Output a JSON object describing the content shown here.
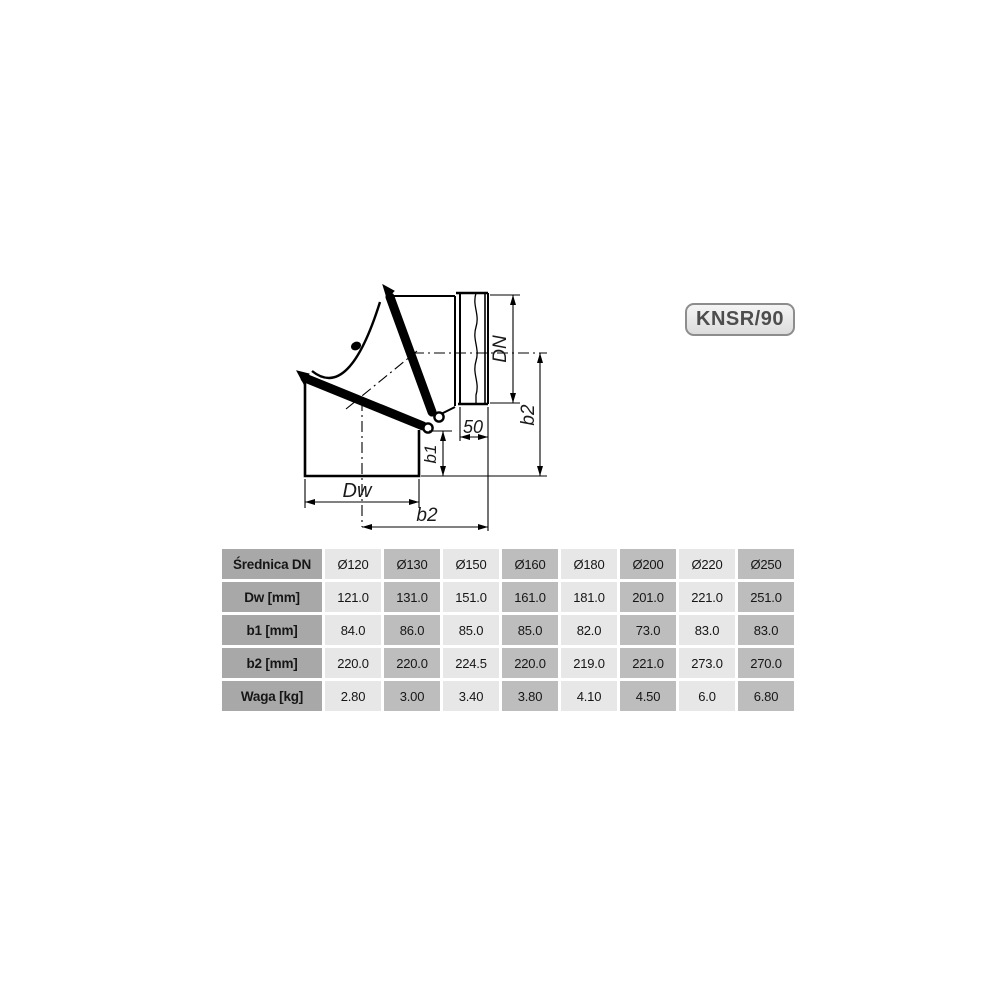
{
  "badge": {
    "label": "KNSR/90"
  },
  "diagram": {
    "labels": {
      "dn": "DN",
      "b2_right": "b2",
      "socket_depth": "50",
      "b1": "b1",
      "dw": "Dw",
      "b2_bottom": "b2"
    }
  },
  "table": {
    "rows": [
      {
        "label": "Średnica DN",
        "values": [
          "Ø120",
          "Ø130",
          "Ø150",
          "Ø160",
          "Ø180",
          "Ø200",
          "Ø220",
          "Ø250"
        ]
      },
      {
        "label": "Dw [mm]",
        "values": [
          "121.0",
          "131.0",
          "151.0",
          "161.0",
          "181.0",
          "201.0",
          "221.0",
          "251.0"
        ]
      },
      {
        "label": "b1 [mm]",
        "values": [
          "84.0",
          "86.0",
          "85.0",
          "85.0",
          "82.0",
          "73.0",
          "83.0",
          "83.0"
        ]
      },
      {
        "label": "b2 [mm]",
        "values": [
          "220.0",
          "220.0",
          "224.5",
          "220.0",
          "219.0",
          "221.0",
          "273.0",
          "270.0"
        ]
      },
      {
        "label": "Waga [kg]",
        "values": [
          "2.80",
          "3.00",
          "3.40",
          "3.80",
          "4.10",
          "4.50",
          "6.0",
          "6.80"
        ]
      }
    ]
  },
  "colors": {
    "line": "#000000",
    "table_label_column": "#a8a8a8",
    "table_column_dark": "#bdbdbd",
    "table_column_light": "#e7e7e7",
    "badge_border": "#8d8d8d",
    "badge_text": "#4d4d4d"
  }
}
